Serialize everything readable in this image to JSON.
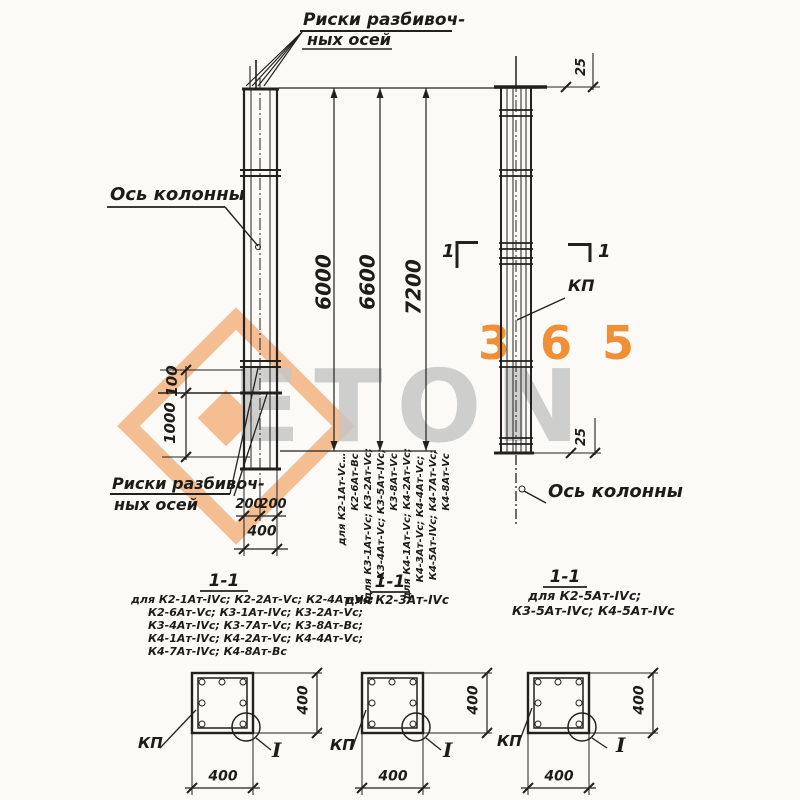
{
  "drawing": {
    "top_note_line1": "Риски разбивоч-",
    "top_note_line2": "ных осей",
    "bottom_note_line1": "Риски разбивоч-",
    "bottom_note_line2": "ных осей",
    "axis_label_left": "Ось колонны",
    "axis_label_right": "Ось колонны",
    "kp_label": "КП",
    "section_digit_left": "1",
    "section_digit_right": "1"
  },
  "dimensions": {
    "len_6000": "6000",
    "len_6600": "6600",
    "len_7200": "7200",
    "off_100": "100",
    "off_1000": "1000",
    "w_200_left": "200",
    "w_200_right": "200",
    "w_400": "400",
    "top_25": "25",
    "bottom_25": "25"
  },
  "dim_notes": {
    "n6000": [
      "для К2-1Ат-Vс…",
      "К2-6Ат-Вс"
    ],
    "n6600": [
      "для К3-1Ат-Vс; К3-2Ат-Vс;",
      "К3-4Ат-Vс; К3-5Ат-IVс;",
      "К3-8Ат-Vс"
    ],
    "n7200": [
      "для К4-1Ат-Vс; К4-2Ат-Vс;",
      "К4-3Ат-Vс; К4-4Ат-Vс;",
      "К4-5Ат-IVс; К4-7Ат-Vс;",
      "К4-8Ат-Vс"
    ]
  },
  "sections": [
    {
      "title": "1-1",
      "kp": "КП",
      "detail_mark": "I",
      "dim_w": "400",
      "dim_h": "400",
      "notes": [
        "для К2-1Ат-IVс; К2-2Ат-Vс; К2-4Ат-Vс;",
        "К2-6Ат-Vс; К3-1Ат-IVс; К3-2Ат-Vс;",
        "К3-4Ат-IVс; К3-7Ат-Vс; К3-8Ат-Вс;",
        "К4-1Ат-IVс; К4-2Ат-Vс; К4-4Ат-Vс;",
        "К4-7Ат-IVс; К4-8Ат-Вс"
      ]
    },
    {
      "title": "1-1",
      "kp": "КП",
      "detail_mark": "I",
      "dim_w": "400",
      "dim_h": "400",
      "notes": [
        "для К2-3Ат-IVс"
      ]
    },
    {
      "title": "1-1",
      "kp": "КП",
      "detail_mark": "I",
      "dim_w": "400",
      "dim_h": "400",
      "notes": [
        "для К2-5Ат-IVс;",
        "К3-5Ат-IVс; К4-5Ат-IVс"
      ]
    }
  ],
  "watermark": {
    "brand": "ETON",
    "number": "365",
    "orange": "#ee7f2d",
    "gray": "#c8c8c8"
  }
}
